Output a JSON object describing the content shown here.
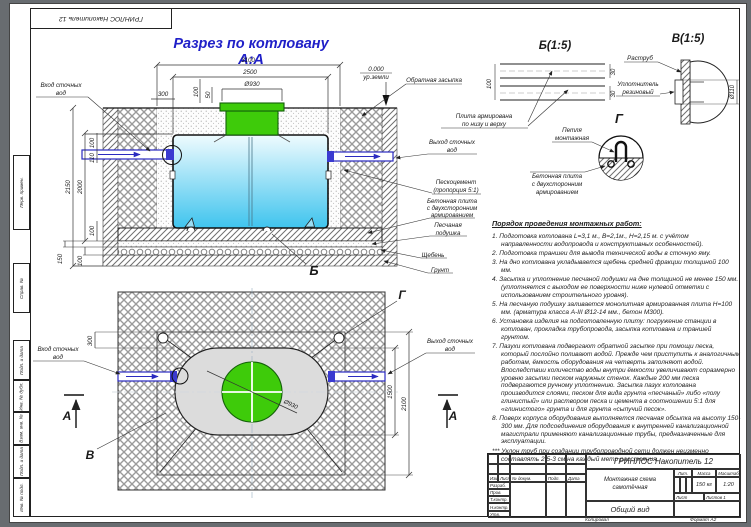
{
  "sheet": {
    "corner_stamp": "ГРИНЛОС Накопитель 12",
    "margin_labels": [
      "Перв. примен.",
      "Справ. №",
      "Подп. и дата",
      "Инв. № дубл.",
      "Взам. инв. №",
      "Подп. и дата",
      "Инв. № подл."
    ],
    "copied_label": "Копировал",
    "format_label": "Формат А2"
  },
  "section_view": {
    "title": "Разрез по котловану А:А",
    "zero_mark": "0.000",
    "ground_level": "ур.земли",
    "labels": {
      "inlet": [
        "Вход сточных",
        "вод"
      ],
      "backfill": [
        "Обратная засыпка"
      ],
      "outlet": [
        "Выход сточных",
        "вод"
      ],
      "sand_cement": [
        "Пескоцемент",
        "(пропорция 5:1)"
      ],
      "slab": [
        "Бетонная плита",
        "с двухсторонним",
        "армированием"
      ],
      "cushion": [
        "Песчаная",
        "подушка"
      ],
      "rubble": [
        "Щебень"
      ],
      "soil": [
        "Грунт"
      ]
    },
    "dims": {
      "pit_width": "3100",
      "tank_width": "2500",
      "neck_dia": "Ø930",
      "offset": "300",
      "neck_h1": "100",
      "neck_h2": "50",
      "depth_total": "2150",
      "depth_tank": "2000",
      "inlet_top": "100",
      "inlet_dia": "110",
      "slab_h": "100",
      "cushion_h": "150",
      "rubble_h": "100"
    },
    "marker_b": "Б"
  },
  "detail_b": {
    "title": "Б(1:5)",
    "dim_thickness": "100",
    "dim_top": "30",
    "dim_bottom": "30",
    "label": [
      "Плита армирована",
      "по низу и верху"
    ]
  },
  "detail_v": {
    "title": "В(1:5)",
    "label_socket": [
      "Раструб"
    ],
    "label_seal": [
      "Уплотнитель",
      "резиновый"
    ],
    "dim_dia": "Ø110"
  },
  "detail_g": {
    "title": "Г",
    "label_loop": [
      "Петля",
      "монтажная"
    ],
    "label_slab": [
      "Бетонная плита",
      "с двухсторонним",
      "армированием"
    ]
  },
  "plan_view": {
    "labels": {
      "inlet": [
        "Вход сточных",
        "вод"
      ],
      "outlet": [
        "Выход сточных",
        "вод"
      ]
    },
    "dims": {
      "offset": "300",
      "tank_width": "1500",
      "pit_width": "2100",
      "lid_dia": "Ø930"
    },
    "marker_a": "А",
    "marker_v": "В",
    "marker_g": "Г"
  },
  "instructions": {
    "title": "Порядок проведения монтажных работ:",
    "items": [
      "1. Подготовка котлована L=3,1 м., В=2,1м., Н=2,15 м. с учётом направленности водопровода и конструктивных особенностей).",
      "2. Подготовка траншеи для вывода технической воды в сточную яму.",
      "3. На дно котлована укладывается щебень средней фракции толщиной 100 мм.",
      "4. Засыпка и уплотнение песчаной подушки на дне толщиной не менее 150 мм. (уплотняется с выходом ее поверхности ниже нулевой отметки с использованием строительного уровня).",
      "5. На песчаную подушку заливается монолитная армированная плита Н=100 мм. (арматура класса А-III Ø12-14 мм., бетон М300).",
      "6. Установка изделия на подготовленную плиту: погружение станции в котлован, прокладка трубопровода, засыпка котлована и траншей грунтом.",
      "7. Пазухи котлована подвергают обратной засыпке при помощи песка, который послойно поливают водой. Прежде чем приступить к аналогичным работам, ёмкость оборудования на четверть заполняют водой. Впоследствии количество воды внутри ёмкости увеличивают соразмерно уровню засыпки песком наружных стенок. Каждые 200 мм песка подвергаются ручному уплотнению. Засыпка пазух котлована производится слоями, песком для вида грунта «песчаный» либо «полу глинистый» или раствором песка и цемента в соотношении 5:1 для «глинистого» грунта и для грунта «сыпучий песок».",
      "8. Поверх корпуса оборудования выполняется песчаная обсыпка на высоту 150-300 мм. Для подсоединения оборудования к внутренней канализационной магистрали применяют канализационные трубы, предназначенные для эксплуатации."
    ],
    "note": "*** Уклон труб при создании трубопроводной сети должен неизменно составлять 2,5-3 см на каждый метр расстояния."
  },
  "title_block": {
    "doc_title": "ГРИНЛОС Накопитель 12",
    "scheme_name": "Монтажная схема самотёчная",
    "view_label": "Общий вид",
    "header_izm": "Изм.",
    "header_list": "Лист",
    "header_docnum": "№ докум.",
    "header_podp": "Подп.",
    "header_data": "Дата",
    "row_razrab": "Разраб.",
    "row_prov": "Пров.",
    "row_tkontr": "Т.контр.",
    "row_nkontr": "Н.контр.",
    "row_utv": "Утв.",
    "lit_label": "Лит.",
    "mass_label": "Масса",
    "scale_label": "Масштаб",
    "mass_value": "150 кг",
    "scale_value": "1:20",
    "sheet_label": "Лист",
    "sheets_label": "Листов 1"
  }
}
